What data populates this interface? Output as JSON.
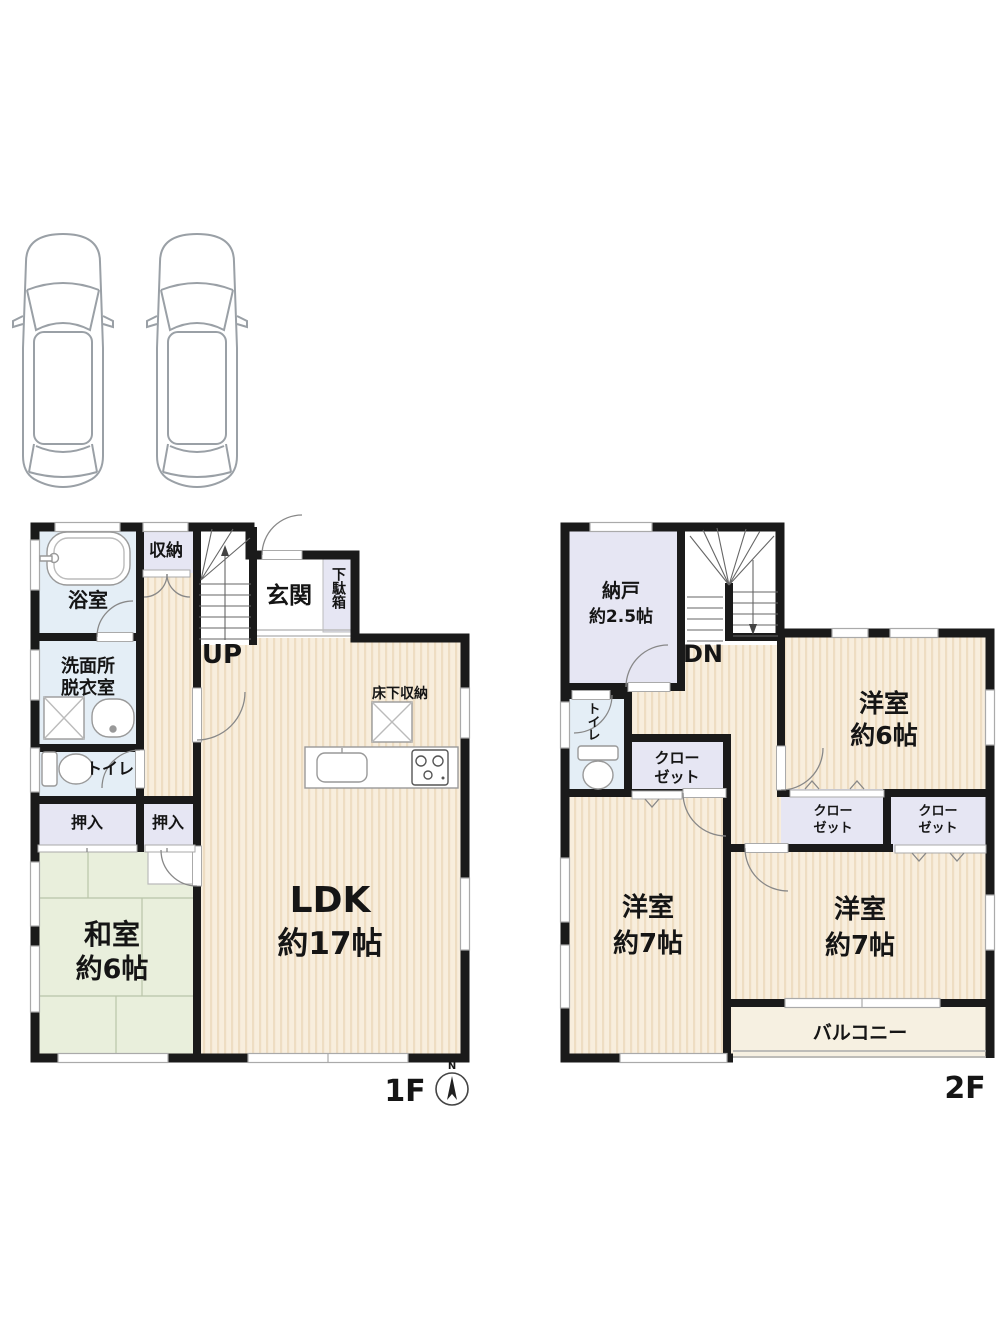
{
  "canvas": {
    "width": 1000,
    "height": 1333,
    "background": "#ffffff"
  },
  "colors": {
    "wall": "#1a1a1a",
    "flooring_base": "#f8eedd",
    "flooring_stripe": "#eeddc2",
    "tatami_fill": "#e9efdc",
    "storage_fill": "#e6e6f3",
    "water_fill": "#e4eef6",
    "balcony_fill": "#f6f0e1",
    "fixture_stroke": "#999999",
    "window_stroke": "#aaaaaa"
  },
  "parking": {
    "spaces": 2
  },
  "floor1": {
    "floor_label": "1F",
    "compass_north": "N",
    "bathroom": "浴室",
    "storage": "収納",
    "entrance": "玄関",
    "shoe_cabinet": "下駄箱",
    "washroom_line1": "洗面所",
    "washroom_line2": "脱衣室",
    "stairs": "UP",
    "underfloor_storage": "床下収納",
    "toilet": "トイレ",
    "closet_left": "押入",
    "closet_right": "押入",
    "japanese_room_line1": "和室",
    "japanese_room_line2": "約6帖",
    "ldk_line1": "LDK",
    "ldk_line2": "約17帖"
  },
  "floor2": {
    "floor_label": "2F",
    "storeroom_line1": "納戸",
    "storeroom_line2": "約2.5帖",
    "stairs": "DN",
    "toilet": "トイレ",
    "closet_hall_line1": "クロー",
    "closet_hall_line2": "ゼット",
    "western_room_6_line1": "洋室",
    "western_room_6_line2": "約6帖",
    "closet_a_line1": "クロー",
    "closet_a_line2": "ゼット",
    "closet_b_line1": "クロー",
    "closet_b_line2": "ゼット",
    "western_room_7_left_line1": "洋室",
    "western_room_7_left_line2": "約7帖",
    "western_room_7_right_line1": "洋室",
    "western_room_7_right_line2": "約7帖",
    "balcony": "バルコニー"
  }
}
